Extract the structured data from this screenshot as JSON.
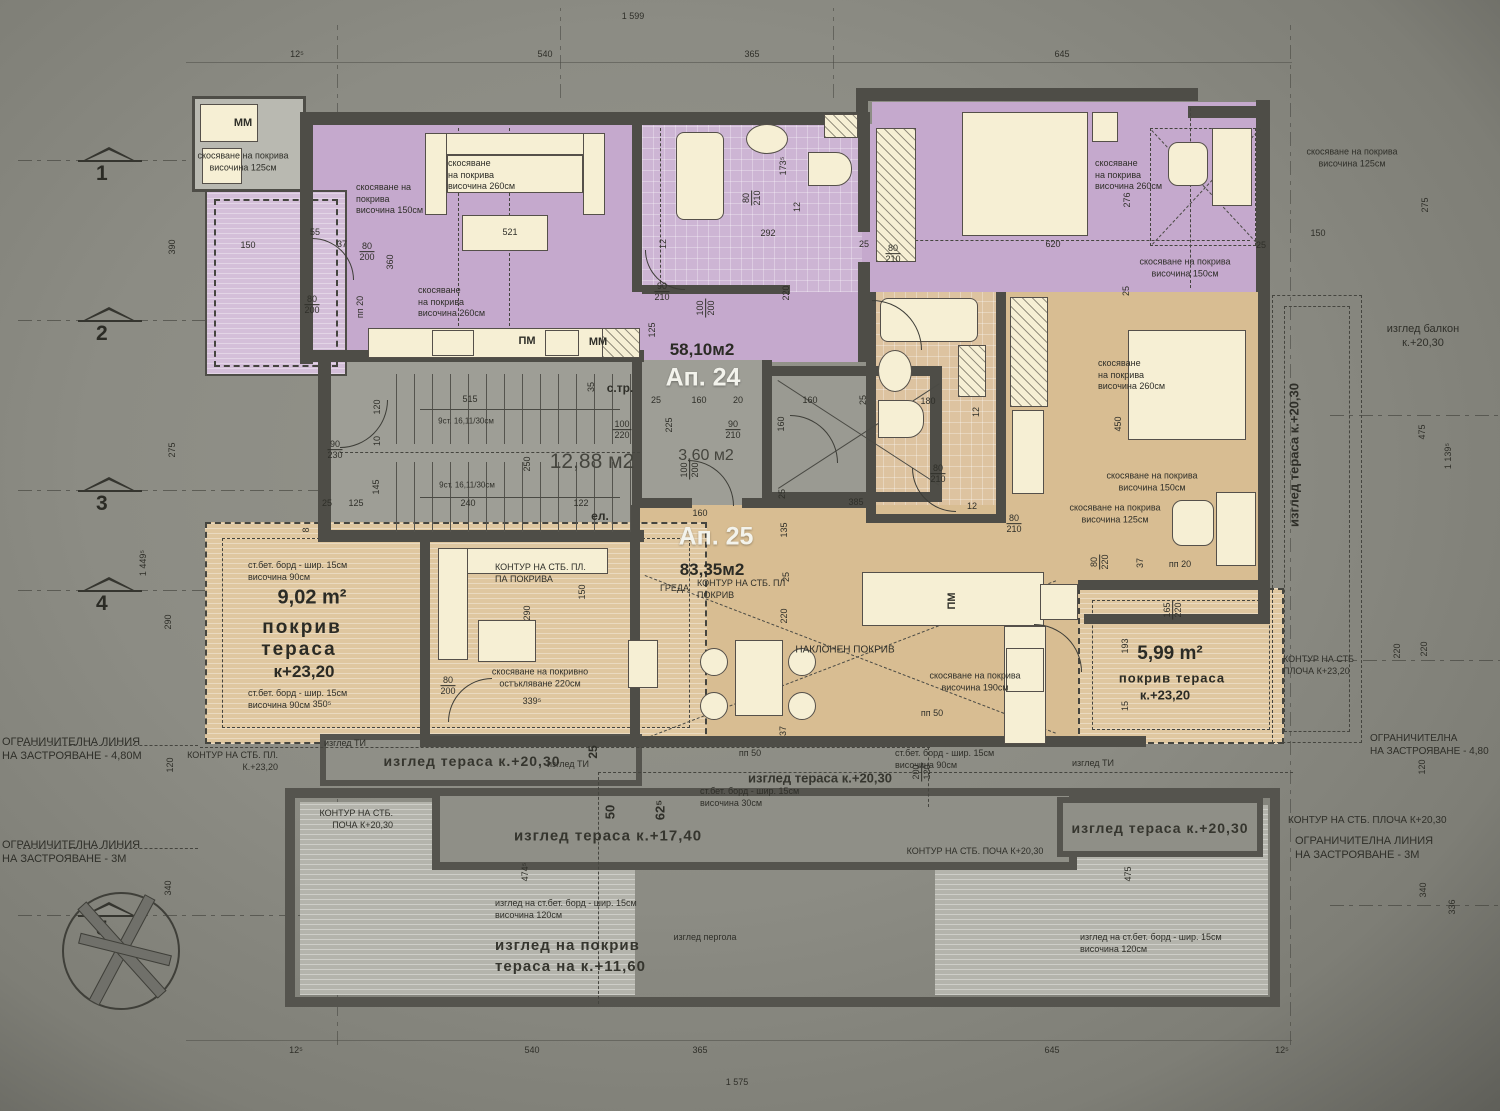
{
  "totals": {
    "top": "1 599",
    "bottom": "1 575"
  },
  "dims_top": [
    "12⁵",
    "540",
    "365",
    "645"
  ],
  "dims_bottom": [
    "12⁵",
    "540",
    "365",
    "645",
    "12⁵"
  ],
  "markers": [
    "1",
    "2",
    "3",
    "4",
    "5"
  ],
  "left_dims": {
    "d390": "390",
    "d275": "275",
    "d1449": "1 449⁵",
    "d290": "290",
    "d120": "120",
    "d340": "340"
  },
  "right_dims": {
    "d275": "275",
    "d150": "150",
    "d475a": "475",
    "d1139": "1 139⁵",
    "d220a": "220",
    "d220b": "220",
    "d120": "120",
    "d340": "340",
    "d336": "336",
    "d475b": "475"
  },
  "apartments": {
    "ap24_label": "Ап. 24",
    "ap24_area": "58,10м2",
    "ap25_label": "Ап. 25",
    "ap25_area": "83,35м2",
    "stair_area": "12,88 м2",
    "stair_label": "с.тр.",
    "elevator_label": "ел.",
    "lobby_area": "3,60 м2",
    "stair_flight": "9ст. 16,11/30см"
  },
  "terraces": {
    "left_area": "9,02 m²",
    "left_line1": "покрив",
    "left_line2": "тераса",
    "left_level": "к+23,20",
    "right_area": "5,99 m²",
    "right_line1": "покрив тераса",
    "right_level": "к.+23,20"
  },
  "ann": {
    "roof125": "скосяване на покрива\nвисочина 125см",
    "roof150": "скосяване на покрива\nвисочина 150см",
    "roof150_3": "скосяване на\nпокрива\nвисочина 150см",
    "roof260": "скосяване\nна покрива\nвисочина 260см",
    "roof260_2": "скосяване\nна покрива\nвисочина 260см",
    "roof190": "скосяване на покрива\nвисочина 190см",
    "roofglaz": "скосяване на покривно\nостъкляване 220см",
    "bord90": "ст.бет. борд - шир. 15см\nвисочина 90см",
    "bord30": "ст.бет. борд - шир. 15см\nвисочина 30см",
    "bord120": "изглед на ст.бет. борд - шир. 15см\nвисочина 120см",
    "kontur_pl_pokriva": "КОНТУР НА СТБ. ПЛ.\nПА ПОКРИВА",
    "kontur_pl_pokriv": "КОНТУР НА СТБ. ПЛ\nПОКРИВ",
    "kontur_pl_2320": "КОНТУР НА СТБ. ПЛ.\nК.+23,20",
    "kontur_plocha_2320": "КОНТУР НА СТБ\nПЛОЧА К+23,20",
    "kontur_plocha_2030": "КОНТУР НА СТБ. ПЛОЧА К+20,30",
    "kontur_pocha_2030": "КОНТУР НА СТБ. ПОЧА К+20,30",
    "kontur_pocha_2030b": "КОНТУР НА СТБ.\nПОЧА К+20,30",
    "limit48": "ОГРАНИЧИТЕЛНА ЛИНИЯ\nНА ЗАСТРОЯВАНЕ - 4,80М",
    "limit48r": "ОГРАНИЧИТЕЛНА\nНА ЗАСТРОЯВАНЕ - 4,80",
    "limit3": "ОГРАНИЧИТЕЛНА ЛИНИЯ\nНА ЗАСТРОЯВАНЕ - 3М",
    "greda": "ГРЕДА",
    "naklonen": "НАКЛОНЕН ПОКРИВ",
    "izgled_balkon": "изглед балкон\nк.+20,30",
    "izgled_terasa2030": "изглед тераса к.+20,30",
    "izgled_terasa1740": "изглед тераса к.+17,40",
    "izgled_pokriv1160": "изглед на покрив\nтераса на к.+11,60",
    "izgled_pergola": "изглед пергола",
    "izgled_ti": "изглед ТИ",
    "pp20": "пп 20",
    "pp50": "пп 50",
    "pm": "ПМ",
    "mm": "ММ"
  },
  "fr": {
    "f80_200": [
      "80",
      "200"
    ],
    "f80_210": [
      "80",
      "210"
    ],
    "f90_210": [
      "90",
      "210"
    ],
    "f100_200": [
      "100",
      "200"
    ],
    "f100_220": [
      "100",
      "220"
    ],
    "f90_230": [
      "90",
      "230"
    ],
    "f80_220": [
      "80",
      "220"
    ],
    "f165_220": [
      "165",
      "220"
    ],
    "f200_120": [
      "200",
      "120"
    ]
  },
  "n": {
    "8": "8",
    "10": "10",
    "12": "12",
    "15": "15",
    "20": "20",
    "25": "25",
    "35": "35",
    "37": "37",
    "50": "50",
    "55": "55",
    "120": "120",
    "122": "122",
    "125": "125",
    "135": "135",
    "145": "145",
    "150": "150",
    "160": "160",
    "165": "165",
    "180": "180",
    "193": "193",
    "220": "220",
    "225": "240x",
    "240": "240",
    "250": "250",
    "276": "276",
    "290": "290",
    "292": "292",
    "360": "360",
    "385": "385",
    "450": "450",
    "515": "515",
    "521": "521",
    "620": "620",
    "s625": "62⁵",
    "s1735": "173⁵",
    "s3505": "350⁵",
    "s3395": "339⁵",
    "s4745": "474⁵",
    "v225": "225"
  },
  "watermark": "Properties"
}
